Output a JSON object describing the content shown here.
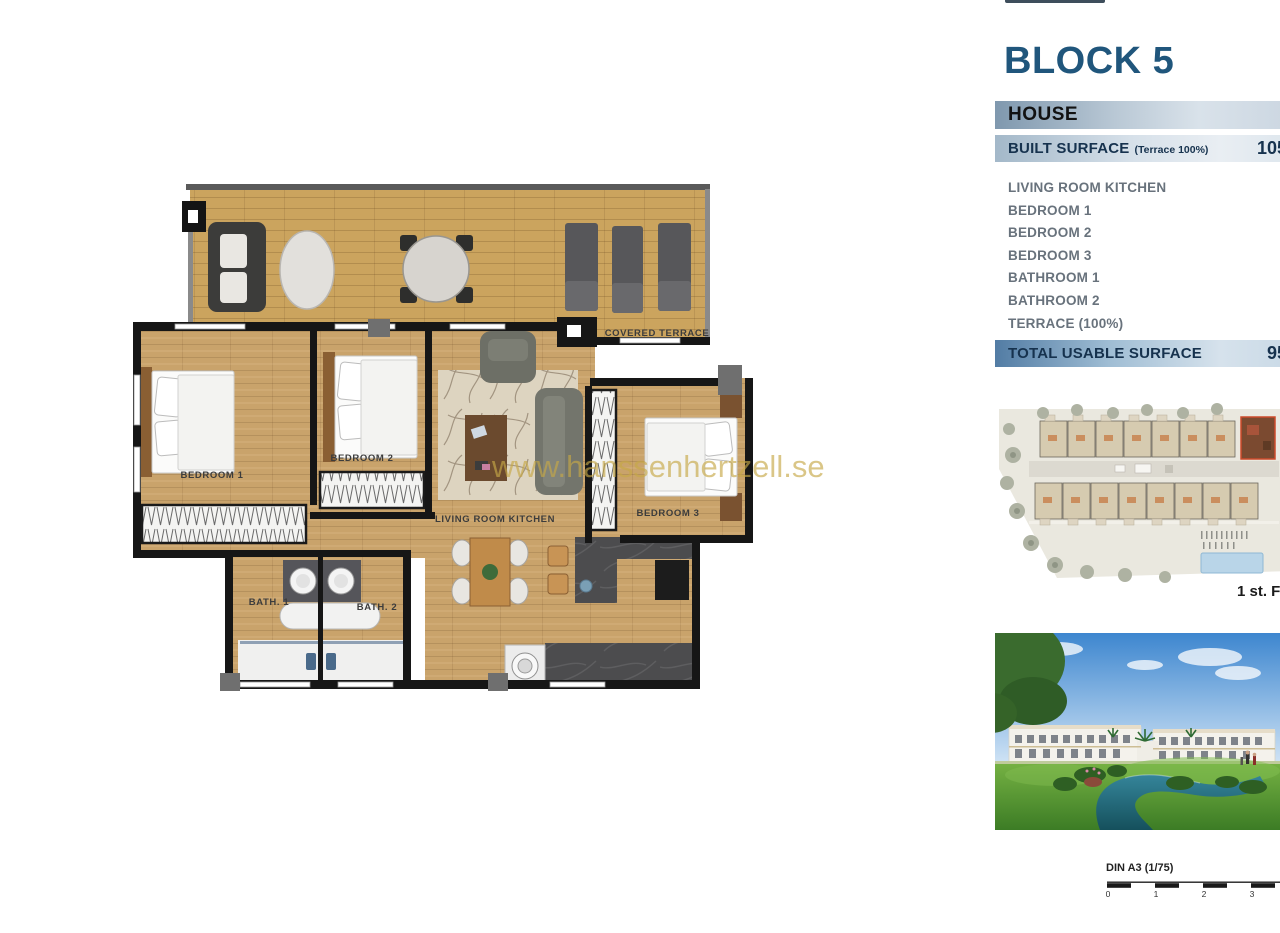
{
  "colors": {
    "title_blue": "#20567c",
    "bar_text_navy": "#16324e",
    "room_text_gray": "#68727c",
    "watermark_gold": "#c6a846",
    "wood": "#c9a36b",
    "wall_black": "#1a1a1a",
    "highlight_unit_red": "#cc4a2a"
  },
  "panel": {
    "title": "BLOCK 5",
    "house_header": "HOUSE",
    "built_surface": {
      "label": "BUILT SURFACE",
      "note": "(Terrace 100%)",
      "value": "105"
    },
    "rooms": [
      "LIVING ROOM KITCHEN",
      "BEDROOM 1",
      "BEDROOM 2",
      "BEDROOM 3",
      "BATHROOM 1",
      "BATHROOM 2",
      "TERRACE (100%)"
    ],
    "total_usable": {
      "label": "TOTAL USABLE SURFACE",
      "value": "95"
    },
    "site_plan_caption": "1 st. Fl"
  },
  "floor_plan": {
    "labels": {
      "covered_terrace": "COVERED TERRACE",
      "bedroom_1": "BEDROOM 1",
      "bedroom_2": "BEDROOM 2",
      "bedroom_3": "BEDROOM 3",
      "living_room_kitchen": "LIVING ROOM KITCHEN",
      "bath_1": "BATH. 1",
      "bath_2": "BATH. 2"
    },
    "watermark": "www.hanssenhertzell.se"
  },
  "scale_bar": {
    "label": "DIN A3 (1/75)",
    "ticks": [
      "0",
      "1",
      "2",
      "3"
    ]
  }
}
